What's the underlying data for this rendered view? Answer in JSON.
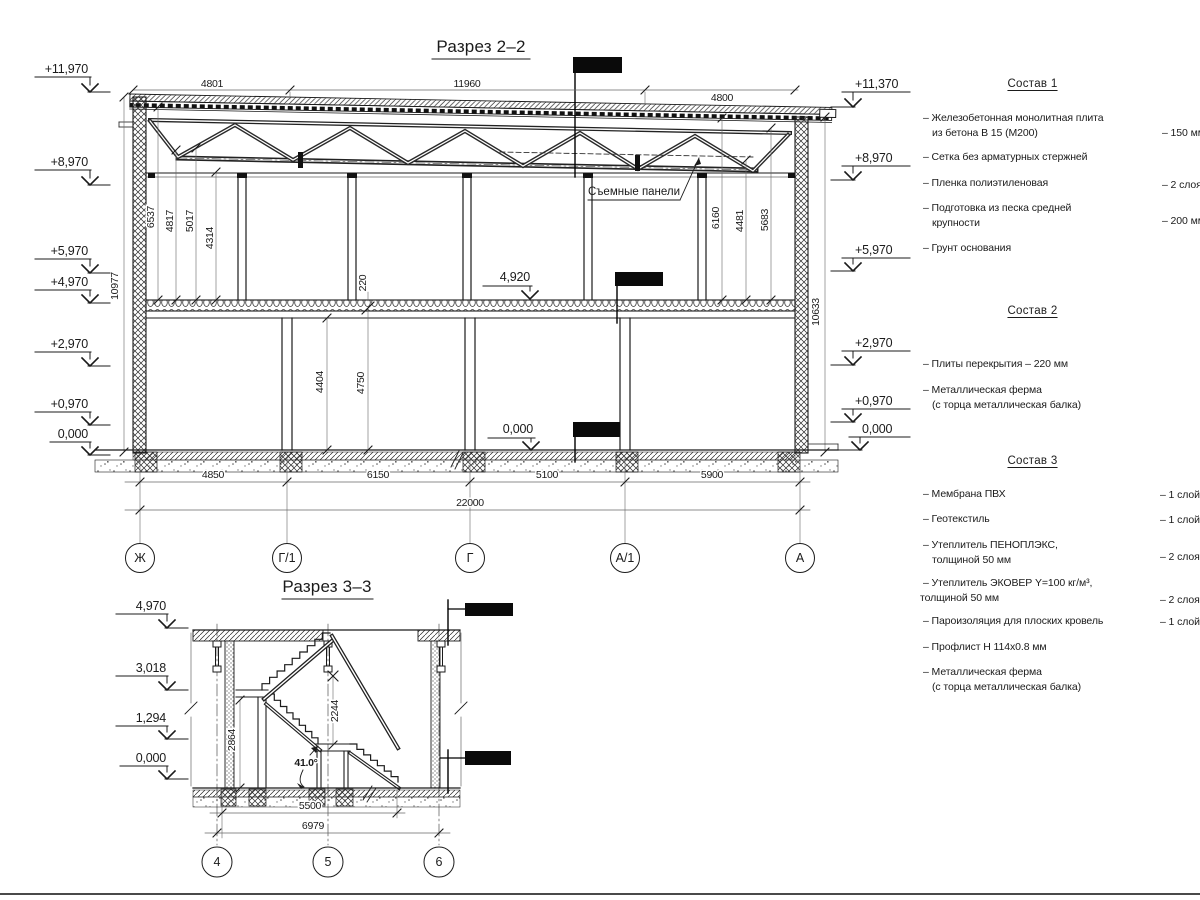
{
  "section22": {
    "title": "Разрез 2–2",
    "top_dims": {
      "d1": "4801",
      "d2": "11960",
      "d3": "4800"
    },
    "left_elevations": {
      "e1": "+11,970",
      "e2": "+8,970",
      "e3": "+5,970",
      "e4": "+4,970",
      "e5": "+2,970",
      "e6": "+0,970",
      "e7": "0,000"
    },
    "right_elevations": {
      "e1": "+11,370",
      "e2": "+8,970",
      "e3": "+5,970",
      "e4": "+2,970",
      "e5": "+0,970",
      "e6": "0,000"
    },
    "height_left": "10977",
    "height_right": "10633",
    "upper_left": {
      "d1": "6537",
      "d2": "4817",
      "d3": "5017",
      "d4": "4314"
    },
    "upper_right": {
      "d1": "6160",
      "d2": "4481",
      "d3": "5683"
    },
    "slab_dim": "220",
    "lower_dims": {
      "d1": "4404",
      "d2": "4750"
    },
    "mid_mark": "4,920",
    "floor_mark": "0,000",
    "panels_label": "Съемные панели",
    "bottom_dims": {
      "d1": "4850",
      "d2": "6150",
      "d3": "5100",
      "d4": "5900",
      "total": "22000"
    },
    "axes": {
      "a1": "Ж",
      "a2": "Г/1",
      "a3": "Г",
      "a4": "А/1",
      "a5": "А"
    }
  },
  "section33": {
    "title": "Разрез 3–3",
    "elevations": {
      "e1": "4,970",
      "e2": "3,018",
      "e3": "1,294",
      "e4": "0,000"
    },
    "dims": {
      "h1": "2864",
      "h2": "2244",
      "angle": "41.0°",
      "w1": "5500",
      "w2": "6979"
    },
    "axes": {
      "a1": "4",
      "a2": "5",
      "a3": "6"
    }
  },
  "comp1": {
    "title": "Состав 1",
    "i1l1": "– Железобетонная  монолитная плита",
    "i1l2": "из бетона В 15 (М200)",
    "i1v": "– 150 мм",
    "i2": "– Сетка без арматурных стержней",
    "i3": "– Пленка полиэтиленовая",
    "i3v": "– 2 слоя",
    "i4l1": "– Подготовка из песка средней",
    "i4l2": "крупности",
    "i4v": "– 200 мм",
    "i5": "– Грунт основания"
  },
  "comp2": {
    "title": "Состав 2",
    "i1": "– Плиты перекрытия – 220 мм",
    "i2l1": "– Металлическая ферма",
    "i2l2": "(с торца металлическая балка)"
  },
  "comp3": {
    "title": "Состав 3",
    "i1": "– Мембрана ПВХ",
    "i1v": "– 1 слой",
    "i2": "– Геотекстиль",
    "i2v": "– 1 слой",
    "i3l1": "– Утеплитель ПЕНОПЛЭКС,",
    "i3l2": "толщиной 50 мм",
    "i3v": "– 2 слоя",
    "i4l1": "– Утеплитель ЭКОВЕР Y=100 кг/м³,",
    "i4l2": "толщиной 50 мм",
    "i4v": "– 2 слоя",
    "i5": "– Пароизоляция для плоских кровель",
    "i5v": "– 1 слой",
    "i6": "– Профлист Н 114х0.8 мм",
    "i7l1": "– Металлическая ферма",
    "i7l2": "(с торца металлическая балка)"
  }
}
